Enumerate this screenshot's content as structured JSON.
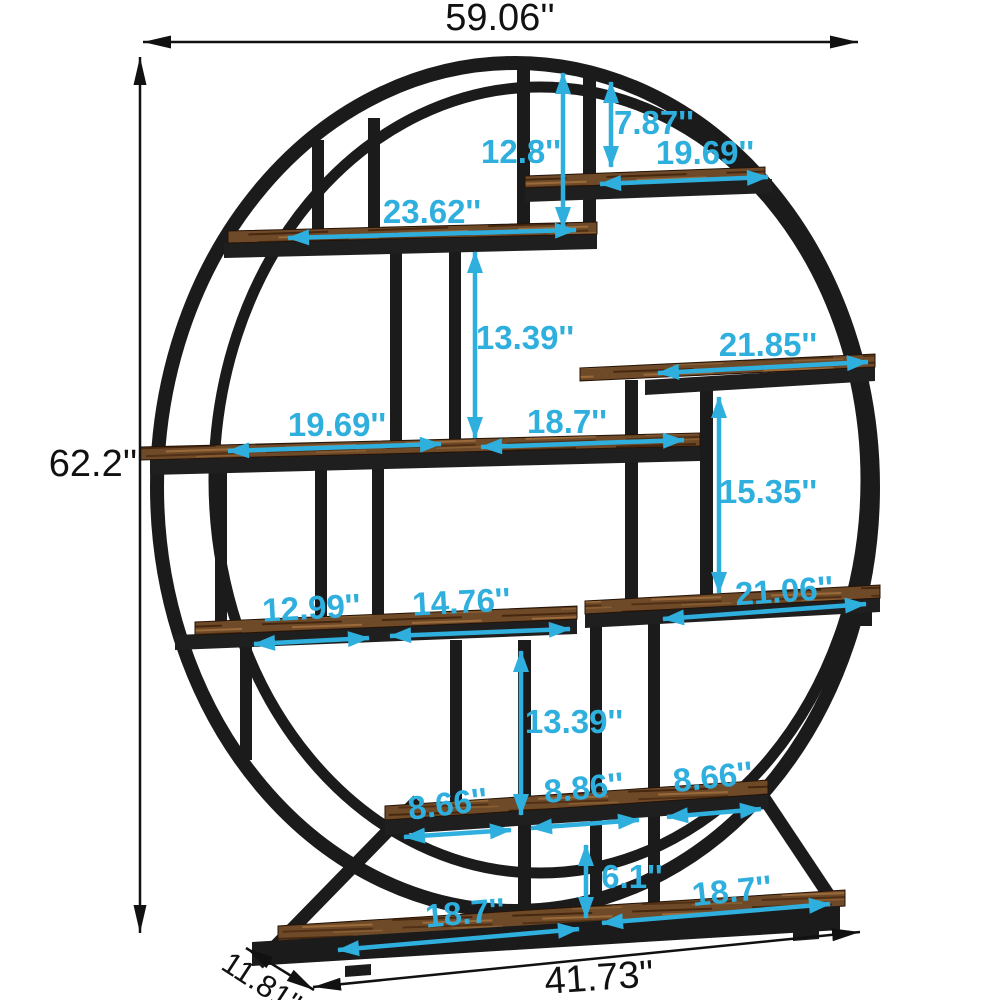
{
  "colors": {
    "dimension_accent": "#2fafdd",
    "frame_black": "#1b1b1b",
    "outline_black": "#111111",
    "wood_brown": "#6f4a28",
    "wood_dark": "#46270f",
    "wood_light": "#9a6a3a"
  },
  "annotations": {
    "black": [
      {
        "id": "overall-width",
        "label": "59.06''"
      },
      {
        "id": "overall-height",
        "label": "62.2''"
      },
      {
        "id": "base-width",
        "label": "41.73''"
      },
      {
        "id": "base-depth",
        "label": "11.81''"
      }
    ],
    "cyan": [
      {
        "id": "top-clearance-height",
        "label": "12.8''"
      },
      {
        "id": "top-right-clearance-height",
        "label": "7.87''"
      },
      {
        "id": "top-right-shelf-width",
        "label": "19.69''"
      },
      {
        "id": "upper-shelf-width",
        "label": "23.62''"
      },
      {
        "id": "upper-clearance-height",
        "label": "13.39''"
      },
      {
        "id": "right-shelf-width",
        "label": "21.85''"
      },
      {
        "id": "middle-left-span",
        "label": "19.69''"
      },
      {
        "id": "middle-right-span",
        "label": "18.7''"
      },
      {
        "id": "right-clearance-height",
        "label": "15.35''"
      },
      {
        "id": "lower-left-span",
        "label": "12.99''"
      },
      {
        "id": "lower-mid-span",
        "label": "14.76''"
      },
      {
        "id": "lower-right-shelf-width",
        "label": "21.06''"
      },
      {
        "id": "lower-clearance-height",
        "label": "13.39''"
      },
      {
        "id": "bottom-left-span",
        "label": "8.66''"
      },
      {
        "id": "bottom-mid-span",
        "label": "8.86''"
      },
      {
        "id": "bottom-right-span",
        "label": "8.66''"
      },
      {
        "id": "base-clearance-height",
        "label": "6.1''"
      },
      {
        "id": "base-left-span",
        "label": "18.7''"
      },
      {
        "id": "base-right-span",
        "label": "18.7''"
      }
    ]
  }
}
